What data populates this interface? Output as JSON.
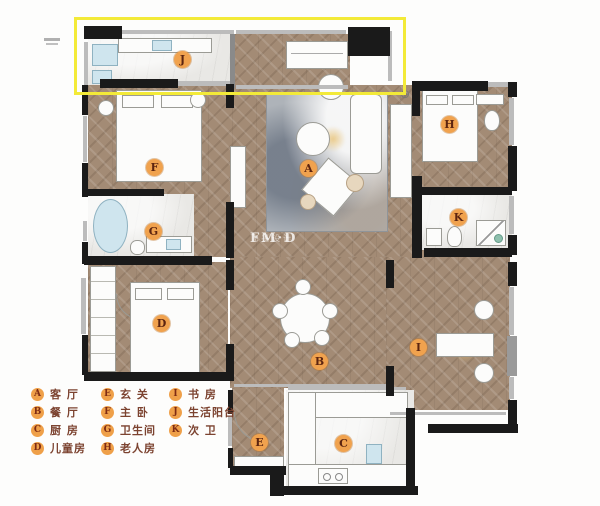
{
  "colors": {
    "highlight_box": "#f3ea38",
    "room_label_bg": "#f0a24e",
    "room_label_text": "#5c2410",
    "legend_text": "#7c4330",
    "wood_floor": "#a38b75",
    "marble_floor": "#e9e8e5",
    "wall": "#1a1a1a",
    "fixture_blue": "#cfe5ee"
  },
  "icons": {
    "ac_unit": "⊕"
  },
  "watermark": {
    "logo": "FM·D",
    "subtitle": "飞墨设计"
  },
  "plan": {
    "labels": [
      {
        "key": "J"
      },
      {
        "key": "F"
      },
      {
        "key": "A"
      },
      {
        "key": "H"
      },
      {
        "key": "G"
      },
      {
        "key": "K"
      },
      {
        "key": "D"
      },
      {
        "key": "B"
      },
      {
        "key": "I"
      },
      {
        "key": "E"
      },
      {
        "key": "C"
      }
    ]
  },
  "legend": {
    "columns": [
      [
        {
          "key": "A",
          "label": "客 厅"
        },
        {
          "key": "B",
          "label": "餐 厅"
        },
        {
          "key": "C",
          "label": "厨 房"
        },
        {
          "key": "D",
          "label": "儿童房"
        }
      ],
      [
        {
          "key": "E",
          "label": "玄 关"
        },
        {
          "key": "F",
          "label": "主 卧"
        },
        {
          "key": "G",
          "label": "卫生间"
        },
        {
          "key": "H",
          "label": "老人房"
        }
      ],
      [
        {
          "key": "I",
          "label": "书 房"
        },
        {
          "key": "J",
          "label": "生活阳台"
        },
        {
          "key": "K",
          "label": "次 卫"
        }
      ]
    ]
  }
}
